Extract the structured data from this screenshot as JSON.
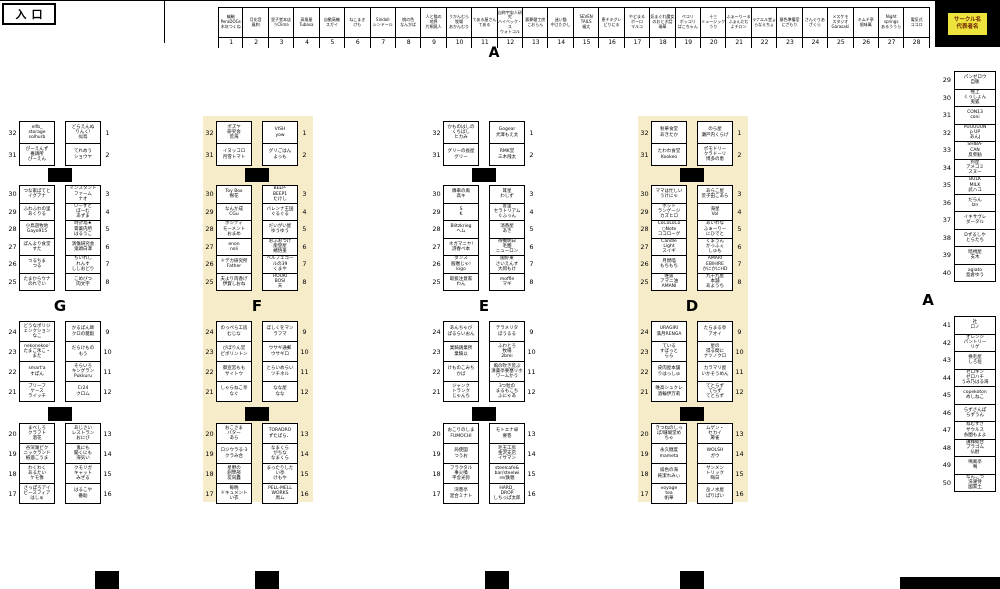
{
  "entrance": "入口",
  "legend": {
    "text": "サークル名\n代表者名"
  },
  "letters": {
    "top": "A",
    "right": "A"
  },
  "colors": {
    "highlight": "#f7ecca",
    "legend_bg": "#ece33c",
    "legend_text": "#6b1d00"
  },
  "top_row": [
    {
      "n": 1,
      "label": "縞軸\nPeraDOGs\n木灰つくね"
    },
    {
      "n": 2,
      "label": "月化音\n風刺"
    },
    {
      "n": 3,
      "label": "里子堂本店\nうClima"
    },
    {
      "n": 4,
      "label": "高角屋\nTubasa"
    },
    {
      "n": 5,
      "label": "自動高機\nスガイ"
    },
    {
      "n": 6,
      "label": "ねこまき\nけも"
    },
    {
      "n": 7,
      "label": "Sindoll\nシンドール"
    },
    {
      "n": 8,
      "label": "桃の色\nなんかぱ"
    },
    {
      "n": 9,
      "label": "人と猫の\n地界\n片桐晃人"
    },
    {
      "n": 10,
      "label": "うかんむら\n牧場\nあかんむり"
    },
    {
      "n": 11,
      "label": "てある屋さん\nてある"
    },
    {
      "n": 12,
      "label": "自称宇宙人研究\nハイベック・ス\nウォトコル"
    },
    {
      "n": 13,
      "label": "悪夢健工房\nこおらん"
    },
    {
      "n": 14,
      "label": "迷い猫\n中江たかし"
    },
    {
      "n": 15,
      "label": "SEVEN\nTAILS\n福太"
    },
    {
      "n": 16,
      "label": "恵チキグレ\nどりにる"
    },
    {
      "n": 17,
      "label": "やどまる\nボーロ\nマルコ"
    },
    {
      "n": 18,
      "label": "気まぐれ魔女\nのおとぎ話\n瑞華"
    },
    {
      "n": 19,
      "label": "ペコリ\nボッコリ\nぱこちゃん"
    },
    {
      "n": 20,
      "label": "十三\nミュージック\nうり"
    },
    {
      "n": 21,
      "label": "ふぁーりーる\nふぁんだむ\nよチロン"
    },
    {
      "n": 22,
      "label": "ラナエル堂ょ\nらなえちょ"
    },
    {
      "n": 23,
      "label": "猿色準備室\nにざもり"
    },
    {
      "n": 24,
      "label": "さんぐりあ\nざくら"
    },
    {
      "n": 25,
      "label": "メスケモ\nスタジオ\nGarasaki"
    },
    {
      "n": 26,
      "label": "キムチ亭\n個味萬"
    },
    {
      "n": 27,
      "label": "Night\nsprings\nあるううら"
    },
    {
      "n": 28,
      "label": "電気式\nココロ"
    }
  ],
  "columns": [
    {
      "letter": "G",
      "highlighted": false,
      "blocks": [
        [
          {
            "ln": 32,
            "l": "elfb_\nstorage\nsolhurb",
            "r": "どらえんぬ\nりんく!\n似鳥",
            "rn": 1
          },
          {
            "ln": 31,
            "l": "ぴーえんず\n養鶏所\nぴーえん",
            "r": "てれめう\nショウヤ",
            "rn": 2
          }
        ],
        [
          {
            "ln": 30,
            "l": "つな家ぽてと\nイグアナ",
            "r": "インスタント\nファーム\nナオ",
            "rn": 3
          },
          {
            "ln": 29,
            "l": "ふわふわの里\nあくりる",
            "r": "いーずと\nぼーむ\nあずま",
            "rn": 4
          },
          {
            "ln": 28,
            "l": "小鳥遊牧地\nGayo915",
            "r": "時計塔★\n膏薬内所\nはるうこ",
            "rn": 5
          },
          {
            "ln": 27,
            "l": "ぼんより食堂\nすた",
            "r": "演傷研究会\n鬼頭白澤",
            "rn": 6
          },
          {
            "ln": 26,
            "l": "つるちま\nつる",
            "r": "ちいれし\nれんす\nししおどり",
            "rn": 7
          },
          {
            "ln": 25,
            "l": "たまからウナ\nのれでい",
            "r": "こめびつ\n肉文字",
            "rn": 8
          }
        ],
        [
          {
            "ln": 24,
            "l": "どうなポリジ\nェンクション\nなこ",
            "r": "かるぱん師\nクロの雑穀",
            "rn": 9
          },
          {
            "ln": 23,
            "l": "nekonekoo'\nたまご氷こ・\nまた",
            "r": "だらけもの\nもう",
            "rn": 10
          },
          {
            "ln": 22,
            "l": "smart'a\nすぽん",
            "r": "そらいろ\nキングラン\nPukkuru",
            "rn": 11
          },
          {
            "ln": 21,
            "l": "ブリーフ\nケース\nライッチ",
            "r": "Cr24\nクロム",
            "rn": 12
          }
        ],
        [
          {
            "ln": 20,
            "l": "まべしろ\nクラフト\n酒花",
            "r": "あじさい\nレストラン\nおにび",
            "rn": 13
          },
          {
            "ln": 19,
            "l": "谷深湖ピク\nニックランド\n紙漉こうま",
            "r": "鬼にも\n聞くにも\n海気い",
            "rn": 14
          },
          {
            "ln": 18,
            "l": "わくわく\nあるたい\nケモ像",
            "r": "クモリガ\nキャット\nみぜる",
            "rn": 15
          },
          {
            "ln": 17,
            "l": "さっぽろアイ\nビースフィア\nはしゅ",
            "r": "はるこや\n番助",
            "rn": 16
          }
        ]
      ]
    },
    {
      "letter": "F",
      "highlighted": true,
      "blocks": [
        [
          {
            "ln": 32,
            "l": "ポズヤ\n研究会\n荒海",
            "r": "VISH\nyow",
            "rn": 1
          },
          {
            "ln": 31,
            "l": "イヌッコロ\n月雪トマト",
            "r": "グリごはん\nよっも",
            "rn": 2
          }
        ],
        [
          {
            "ln": 30,
            "l": "Toy Box\n樹花",
            "r": "BEEP-\nBEEP1\nたけし",
            "rn": 3
          },
          {
            "ln": 29,
            "l": "なんか成\nCGu",
            "r": "バレンナ王国\nぐるぐる",
            "rn": 4
          },
          {
            "ln": 28,
            "l": "ポジティ\nモーメント\nおまめ",
            "r": "だいがい屋\nゆうゆう",
            "rn": 5
          },
          {
            "ln": 27,
            "l": "enon\nnoli",
            "r": "おふおつけ\n能登屋\n緒悟兎",
            "rn": 6
          },
          {
            "ln": 26,
            "l": "ドデカ研究所\nFather",
            "r": "ベルフェゴー\nルの39\nくまや",
            "rn": 7
          },
          {
            "ln": 25,
            "l": "夫より肉香げ\n伊賀しおね",
            "r": "HOUKI\nBOSI\n天",
            "rn": 8
          }
        ],
        [
          {
            "ln": 24,
            "l": "のっぺら工房\nむじな",
            "r": "ぼしくをマン\nラフマ",
            "rn": 9
          },
          {
            "ln": 23,
            "l": "びぼりん堂\nピボリントン",
            "r": "ウサギ通郵\nウサギロ",
            "rn": 10
          },
          {
            "ln": 22,
            "l": "御宣宮もも\nサイトウ",
            "r": "とらいめらい\nツチネル",
            "rn": 11
          },
          {
            "ln": 21,
            "l": "しゃらねこ亭\nなぐ",
            "r": "なな屋\nなな",
            "rn": 12
          }
        ],
        [
          {
            "ln": 20,
            "l": "おこさま\nバター\nあら",
            "r": "TORADRO\nずたぱら、",
            "rn": 13
          },
          {
            "ln": 19,
            "l": "ロジウラる-3\nクラみ合",
            "r": "なまくら\nがちな\nなまくら",
            "rn": 14
          },
          {
            "ln": 18,
            "l": "星野の\n創學部\n炭同轟",
            "r": "まったりした\nい亭\nけもや",
            "rn": 15
          },
          {
            "ln": 17,
            "l": "毎晩\nドキュメント\nい衣",
            "r": "PELL-MELL\nWORKS\n周ム",
            "rn": 16
          }
        ]
      ]
    },
    {
      "letter": "E",
      "highlighted": false,
      "blocks": [
        [
          {
            "ln": 32,
            "l": "かものはしの\nくちばし\nヒカみ",
            "r": "Gogear\n犬澤もえ太",
            "rn": 1
          },
          {
            "ln": 31,
            "l": "グリーの長屋\nグリー",
            "r": "RMK堂\n三木飛太",
            "rn": 2
          }
        ],
        [
          {
            "ln": 30,
            "l": "隣車の風\n高キ",
            "r": "耳星\nわしず",
            "rn": 3
          },
          {
            "ln": 29,
            "l": "S\nK",
            "r": "客里\nセラトリアム\nぐふっん",
            "rn": 4
          },
          {
            "ln": 28,
            "l": "Blitzkrieg\nヘム",
            "r": "消香屋\nあき",
            "rn": 5
          },
          {
            "ln": 27,
            "l": "ネガマニヤ!\n詩春ベ本",
            "r": "待機明日\n毛圏\nニューロン",
            "rn": 6
          },
          {
            "ln": 26,
            "l": "ダンス\n服暦じゃ!\nkigo",
            "r": "闇好東\nさいえんす\n大岡もけ",
            "rn": 7
          },
          {
            "ln": 25,
            "l": "取扱注意家\nわん",
            "r": "moffle\nマギ",
            "rn": 8
          }
        ],
        [
          {
            "ln": 24,
            "l": "あんちゃび\nぱるらいおん",
            "r": "テラメリタ\nぼうるる",
            "rn": 9
          },
          {
            "ln": 23,
            "l": "業騎鶏業所\n業騎以",
            "r": "ふわとろ\n牧場\n2bmi",
            "rn": 10
          },
          {
            "ln": 22,
            "l": "けものこみち\nかば",
            "r": "風の吹き荒ぶ\n清薬亭要塞リホ\nワームかう",
            "rn": 11
          },
          {
            "ln": 21,
            "l": "ジャンク\nトランク\nじゃんち",
            "r": "3つ粒の\nまるもこち\nふにゃあ",
            "rn": 12
          }
        ],
        [
          {
            "ln": 20,
            "l": "おこりのしま\nFUMOCHI",
            "r": "モトエナ卓\n要巻",
            "rn": 13
          },
          {
            "ln": 19,
            "l": "局使図\nつうお",
            "r": "毛玉工房\n金沢支店\nイサマン",
            "rn": 14
          },
          {
            "ln": 18,
            "l": "フラクタル\n事火噴\n平舎光弥",
            "r": "steelcafe&\nbar/steelwi\nre/鉄親",
            "rn": 15
          },
          {
            "ln": 17,
            "l": "湾愚亭\n混合ミナト",
            "r": "HARD_\nDROP\nしちっぱ太郎",
            "rn": 16
          }
        ]
      ]
    },
    {
      "letter": "D",
      "highlighted": true,
      "blocks": [
        [
          {
            "ln": 32,
            "l": "秋華食堂\nあきたか",
            "r": "のら屋\n瀬戸内くらげ",
            "rn": 1
          },
          {
            "ln": 31,
            "l": "たわわ食堂\nKookeo",
            "r": "ポモドリー\nクラドーリ\n博多の恵",
            "rn": 2
          }
        ],
        [
          {
            "ln": 30,
            "l": "ママは忙しい\nうけにゃ",
            "r": "あらこ屋\n荒子田こあら",
            "rn": 3
          },
          {
            "ln": 29,
            "l": "ホット\nランゲージ\nカズヒロ",
            "r": "海星\nVol",
            "rn": 4
          },
          {
            "ln": 28,
            "l": "CoCoLoCo\n○Note\nココローグ",
            "r": "あいわな\nふぁーりー\nにひでと",
            "rn": 5
          },
          {
            "ln": 27,
            "l": "Candle\nLight\nスイギ",
            "r": "くまうん\nかっふぇ\nしゅも",
            "rn": 6
          },
          {
            "ln": 26,
            "l": "月燃喵\nもちもち",
            "r": "AMARI\nEBIHIRE\nかにかにHD",
            "rn": 7
          },
          {
            "ln": 25,
            "l": "唯遥\nアマニ油\nAMANI",
            "r": "九十九屋\n本舗\nあようち",
            "rn": 8
          }
        ],
        [
          {
            "ln": 24,
            "l": "URAGIRI\n満月RENGA",
            "r": "たらまる亭\nアオイ",
            "rn": 9
          },
          {
            "ln": 23,
            "l": "ている\nすぼっと\nらら",
            "r": "星の\n得る間に\nナツノクロ",
            "rn": 10
          },
          {
            "ln": 22,
            "l": "皮肉屋本舗\nりはっしゅ",
            "r": "カラマリ屋\nいかそうめん",
            "rn": 11
          },
          {
            "ln": 21,
            "l": "唯高シュクレ\n酒輪伊万莉",
            "r": "てとらず\nてらず\nてとらず",
            "rn": 12
          }
        ],
        [
          {
            "ln": 20,
            "l": "きつねのしっ\nぽ/珊瑚堂め\nちゃ",
            "r": "ムゲン・\nセカイ\n麻雀",
            "rn": 13
          },
          {
            "ln": 19,
            "l": "永久糖度\nmameta",
            "r": "WOLSH\nガウ",
            "rn": 14
          },
          {
            "ln": 18,
            "l": "緋色の海\n純潔れみぃ",
            "r": "サンメン\nトリック\n晦日",
            "rn": 15
          },
          {
            "ln": 17,
            "l": "voyage\ntea\n帆華",
            "r": "岳ノ水屋\nぱりぱい",
            "rn": 16
          }
        ]
      ]
    }
  ],
  "right_col": {
    "groups": [
      [
        {
          "n": 29,
          "t": "パンゼロウ\n自販"
        },
        {
          "n": 30,
          "t": "極上\nくっしょん\n兎狐"
        },
        {
          "n": 31,
          "t": "CON13\nconi"
        },
        {
          "n": 32,
          "t": "PUUUUUN\np UP\nあんJ"
        },
        {
          "n": 33,
          "t": "SHIBA-\nCAN\n反柴勧"
        },
        {
          "n": 34,
          "t": "狗屋\nアメコミ\nスヌー"
        },
        {
          "n": 35,
          "t": "BULK\nMILK\n武ハコ"
        },
        {
          "n": 36,
          "t": "だらん\nIzn"
        },
        {
          "n": 37,
          "t": "イキサヴレ\nダータル"
        },
        {
          "n": 38,
          "t": "Dずるしや\nとらたち"
        },
        {
          "n": 39,
          "t": "暗視屋\n支木"
        },
        {
          "n": 40,
          "t": "agiato\n島倉ゆう"
        }
      ],
      [
        {
          "n": 41,
          "t": "社\nロノ"
        },
        {
          "n": 42,
          "t": "オレンジ\nパントリー\nリゲ"
        },
        {
          "n": 43,
          "t": "换毛屋\nしろ垣"
        },
        {
          "n": 44,
          "t": "ゼロキン\nゼロハチ\nうみ乃はる海"
        },
        {
          "n": 45,
          "t": "copekoton\nめしねこ"
        },
        {
          "n": 46,
          "t": "らずさんぽ\nらずうん"
        },
        {
          "n": 47,
          "t": "ねむすぎ\nザウルス\n糸圏もよよ"
        },
        {
          "n": 48,
          "t": "講釋総合\nプラゴム\n仏酎"
        },
        {
          "n": 49,
          "t": "鳴風亭\n鳴"
        },
        {
          "n": 50,
          "t": "なんこつ\n洗濯侍\n國累土"
        }
      ]
    ]
  }
}
